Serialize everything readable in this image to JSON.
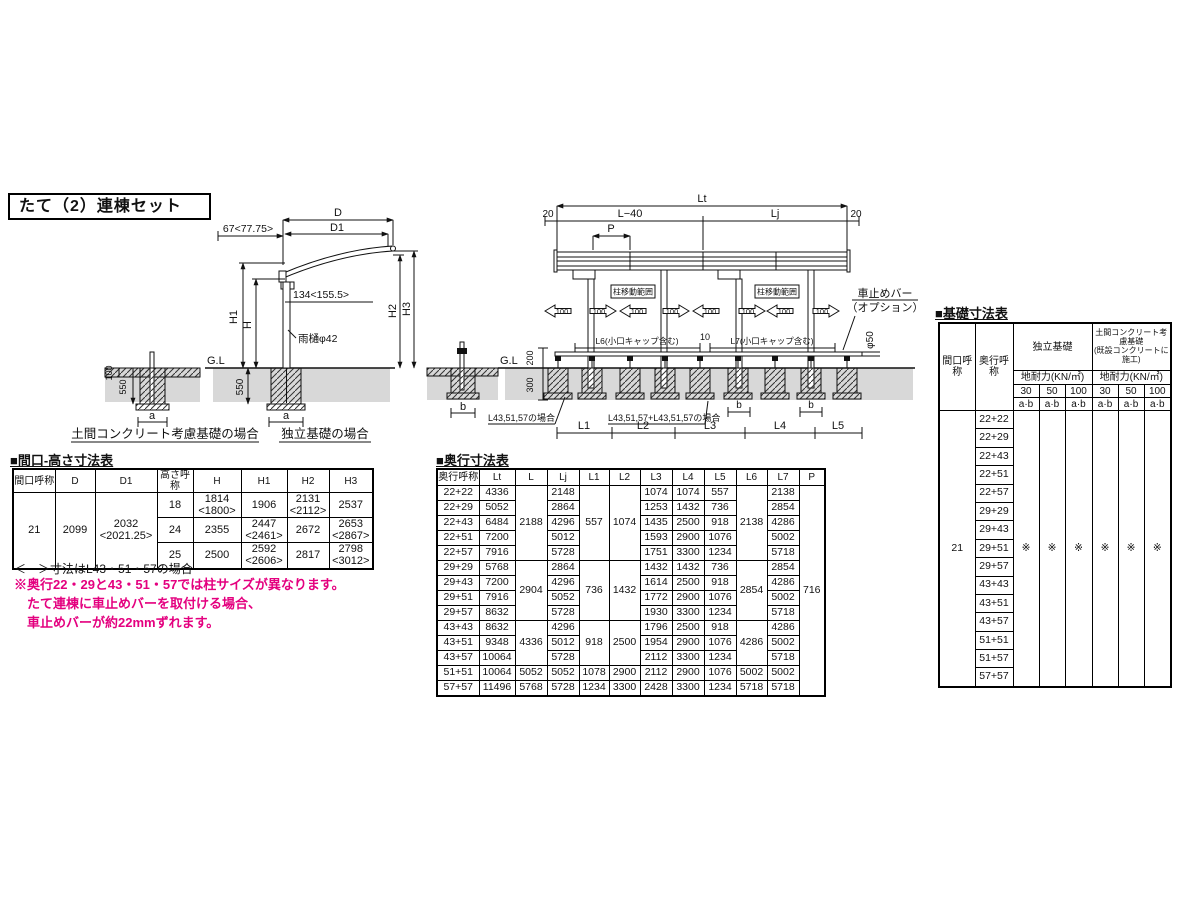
{
  "title": "たて（2）連棟セット",
  "colors": {
    "pink": "#e4007f",
    "ground": "#d8d8d8",
    "line": "#1a1a1a"
  },
  "diagram_left": {
    "d": "D",
    "d1": "D1",
    "overhang": "67<77.75>",
    "beam_h": "134<155.5>",
    "h1": "H1",
    "h": "H",
    "h2": "H2",
    "h3": "H3",
    "gutter": "雨樋φ42",
    "gl": "G.L",
    "dim_100": "100",
    "dim_550": "550",
    "a": "a",
    "caption_doma": "土間コンクリート考慮基礎の場合",
    "caption_indep": "独立基礎の場合"
  },
  "diagram_mid": {
    "lt": "Lt",
    "l40": "L−40",
    "lj": "Lj",
    "d20": "20",
    "p": "P",
    "pillar_range": "柱移動範囲",
    "move": "100",
    "stopper_line1": "車止めバー",
    "stopper_line2": "（オプション）",
    "l6": "L6(小口キャップ含む)",
    "l7": "L7(小口キャップ含む)",
    "gap10": "10",
    "dia50": "φ50",
    "gl": "G.L",
    "dim200": "200",
    "dim300": "300",
    "case1": "L43,51,57の場合",
    "case2": "L43,51,57+L43,51,57の場合",
    "b": "b",
    "l1": "L1",
    "l2": "L2",
    "l3": "L3",
    "l4": "L4",
    "l5": "L5"
  },
  "open_height_table": {
    "title": "■間口-高さ寸法表",
    "headers": [
      "間口呼称",
      "D",
      "D1",
      "高さ呼称",
      "H",
      "H1",
      "H2",
      "H3"
    ],
    "maguchi": "21",
    "d": "2099",
    "d1": "2032\n<2021.25>",
    "rows": [
      {
        "h_code": "18",
        "h": "1814\n<1800>",
        "h1": "1906",
        "h2": "2131\n<2112>",
        "h3": "2537"
      },
      {
        "h_code": "24",
        "h": "2355",
        "h1": "2447\n<2461>",
        "h2": "2672",
        "h3": "2653\n<2867>"
      },
      {
        "h_code": "25",
        "h": "2500",
        "h1": "2592\n<2606>",
        "h2": "2817",
        "h3": "2798\n<3012>"
      }
    ],
    "note": "＜　＞寸法はL43・51・57の場合"
  },
  "pink_notes": {
    "line1": "※奥行22・29と43・51・57では柱サイズが異なります。",
    "line2": "たて連棟に車止めバーを取付ける場合、",
    "line3": "車止めバーが約22mmずれます。"
  },
  "depth_table": {
    "title": "■奥行寸法表",
    "headers": [
      "奥行呼称",
      "Lt",
      "L",
      "Lj",
      "L1",
      "L2",
      "L3",
      "L4",
      "L5",
      "L6",
      "L7",
      "P"
    ],
    "p": "716",
    "groups": [
      {
        "l": "2188",
        "l1": "557",
        "l2": "1074",
        "l6": "2138",
        "rows": [
          {
            "name": "22+22",
            "lt": "4336",
            "lj": "2148",
            "l3": "1074",
            "l4": "1074",
            "l5": "557",
            "l7": "2138"
          },
          {
            "name": "22+29",
            "lt": "5052",
            "lj": "2864",
            "l3": "1253",
            "l4": "1432",
            "l5": "736",
            "l7": "2854"
          },
          {
            "name": "22+43",
            "lt": "6484",
            "lj": "4296",
            "l3": "1435",
            "l4": "2500",
            "l5": "918",
            "l7": "4286"
          },
          {
            "name": "22+51",
            "lt": "7200",
            "lj": "5012",
            "l3": "1593",
            "l4": "2900",
            "l5": "1076",
            "l7": "5002"
          },
          {
            "name": "22+57",
            "lt": "7916",
            "lj": "5728",
            "l3": "1751",
            "l4": "3300",
            "l5": "1234",
            "l7": "5718"
          }
        ]
      },
      {
        "l": "2904",
        "l1": "736",
        "l2": "1432",
        "l6": "2854",
        "rows": [
          {
            "name": "29+29",
            "lt": "5768",
            "lj": "2864",
            "l3": "1432",
            "l4": "1432",
            "l5": "736",
            "l7": "2854"
          },
          {
            "name": "29+43",
            "lt": "7200",
            "lj": "4296",
            "l3": "1614",
            "l4": "2500",
            "l5": "918",
            "l7": "4286"
          },
          {
            "name": "29+51",
            "lt": "7916",
            "lj": "5052",
            "l3": "1772",
            "l4": "2900",
            "l5": "1076",
            "l7": "5002"
          },
          {
            "name": "29+57",
            "lt": "8632",
            "lj": "5728",
            "l3": "1930",
            "l4": "3300",
            "l5": "1234",
            "l7": "5718"
          }
        ]
      },
      {
        "l": "4336",
        "l1": "918",
        "l2": "2500",
        "l6": "4286",
        "rows": [
          {
            "name": "43+43",
            "lt": "8632",
            "lj": "4296",
            "l3": "1796",
            "l4": "2500",
            "l5": "918",
            "l7": "4286"
          },
          {
            "name": "43+51",
            "lt": "9348",
            "lj": "5012",
            "l3": "1954",
            "l4": "2900",
            "l5": "1076",
            "l7": "5002"
          },
          {
            "name": "43+57",
            "lt": "10064",
            "lj": "5728",
            "l3": "2112",
            "l4": "3300",
            "l5": "1234",
            "l7": "5718"
          }
        ]
      },
      {
        "l": "5052",
        "l1": "1078",
        "l2": "2900",
        "l6": "5002",
        "rows": [
          {
            "name": "51+51",
            "lt": "10064",
            "lj": "5052",
            "l3": "2112",
            "l4": "2900",
            "l5": "1076",
            "l7": "5002"
          }
        ]
      },
      {
        "l": "5768",
        "l1": "1234",
        "l2": "3300",
        "l6": "5718",
        "rows": [
          {
            "name": "57+57",
            "lt": "11496",
            "lj": "5728",
            "l3": "2428",
            "l4": "3300",
            "l5": "1234",
            "l7": "5718"
          }
        ]
      }
    ]
  },
  "foundation_table": {
    "title": "■基礎寸法表",
    "col_maguchi": "間口呼称",
    "col_okuyuki": "奥行呼称",
    "independent": "独立基礎",
    "doma": "土間コンクリート考慮基礎\n(既設コンクリートに施工)",
    "bearing": "地耐力(KN/㎡)",
    "loads": [
      "30",
      "50",
      "100"
    ],
    "ab": "a·b",
    "maguchi": "21",
    "depths": [
      "22+22",
      "22+29",
      "22+43",
      "22+51",
      "22+57",
      "29+29",
      "29+43",
      "29+51",
      "29+57",
      "43+43",
      "43+51",
      "43+57",
      "51+51",
      "51+57",
      "57+57"
    ],
    "mark": "※"
  }
}
